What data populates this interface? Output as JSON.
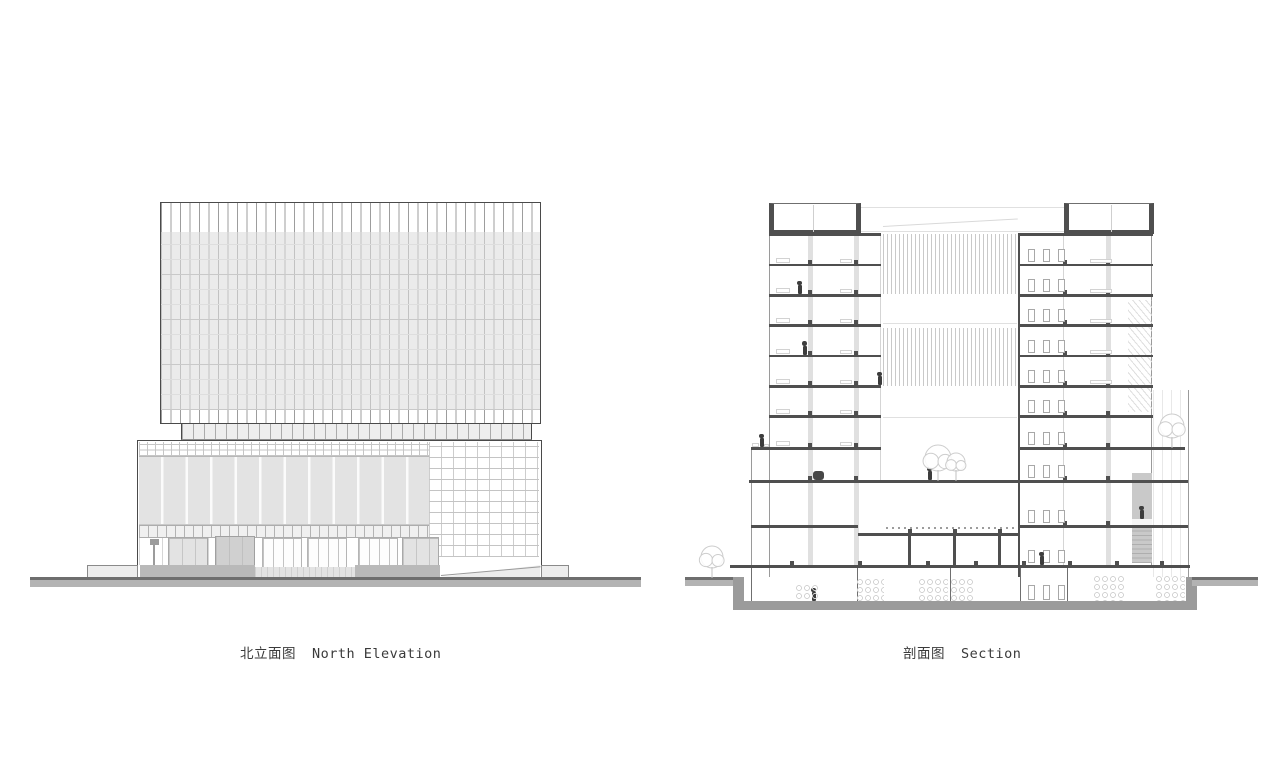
{
  "captions": {
    "elevation_zh": "北立面图",
    "elevation_en": "North Elevation",
    "section_zh": "剖面图",
    "section_en": "Section"
  },
  "colors": {
    "line_dark": "#4f4f4f",
    "ground_band": "#9b9b9b",
    "panel_gray": "#e3e3e3",
    "caption_text": "#3a3a3a",
    "background": "#ffffff"
  },
  "drawing": {
    "rects": [
      [
        "tower-box",
        160,
        202,
        381,
        222
      ],
      [
        "tw-top",
        161,
        203,
        379,
        29
      ],
      [
        "tw-mid",
        161,
        232,
        379,
        178
      ],
      [
        "tw-bot",
        161,
        410,
        379,
        13
      ],
      [
        "stepband",
        181,
        424,
        351,
        16
      ],
      [
        "pd-box",
        137,
        440,
        405,
        137
      ],
      [
        "pd-row1",
        139,
        442,
        290,
        15
      ],
      [
        "pd-panels",
        139,
        457,
        290,
        68
      ],
      [
        "pd-brick",
        429,
        442,
        110,
        115
      ],
      [
        "pd-row2",
        139,
        525,
        290,
        13
      ],
      [
        "pd-store",
        139,
        538,
        300,
        27
      ],
      [
        "door-glass",
        168,
        537,
        40,
        39
      ],
      [
        "door-dark",
        215,
        536,
        40,
        40
      ],
      [
        "bay",
        262,
        538,
        40,
        36
      ],
      [
        "bay",
        307,
        538,
        40,
        36
      ],
      [
        "bay",
        358,
        538,
        40,
        36
      ],
      [
        "door-glass",
        402,
        537,
        37,
        39
      ],
      [
        "flag",
        150,
        539,
        9,
        6
      ],
      [
        "flagpost",
        153,
        540,
        1.5,
        27
      ],
      [
        "sill-dark",
        140,
        565,
        115,
        12
      ],
      [
        "sill-light",
        255,
        567,
        100,
        10
      ],
      [
        "sill-dark",
        355,
        565,
        85,
        12
      ],
      [
        "ramp",
        440,
        564,
        100,
        13
      ],
      [
        "ramp-line",
        441,
        575,
        100,
        1,
        -5
      ],
      [
        "plinth-l",
        87,
        565,
        51,
        12
      ],
      [
        "plinth-r",
        541,
        565,
        28,
        12
      ],
      [
        "ground-el",
        30,
        577,
        611,
        10
      ],
      [
        "roofbox",
        769,
        203,
        92,
        31
      ],
      [
        "roofbox",
        1064,
        203,
        90,
        31
      ],
      [
        "roof-mull",
        813,
        205,
        1,
        27
      ],
      [
        "roof-mull",
        1111,
        205,
        1,
        27
      ],
      [
        "line-h-faint",
        861,
        207,
        203,
        1
      ],
      [
        "line-h-faint",
        861,
        231,
        203,
        1
      ],
      [
        "slope",
        883,
        226,
        135,
        1,
        -3.2
      ],
      [
        "edge-thin",
        769,
        233,
        1,
        344
      ],
      [
        "strip",
        808,
        233,
        5,
        332
      ],
      [
        "strip",
        854,
        233,
        5,
        332
      ],
      [
        "edge-faint",
        880,
        233,
        1,
        247
      ],
      [
        "edge-thin",
        751,
        447,
        1,
        130
      ],
      [
        "cutwall",
        1018,
        233,
        2,
        344
      ],
      [
        "edge-faint",
        1063,
        233,
        1,
        332
      ],
      [
        "strip",
        1106,
        233,
        5,
        332
      ],
      [
        "edge-thin",
        1151,
        233,
        1,
        332
      ],
      [
        "annex",
        1153,
        390,
        36,
        187
      ],
      [
        "edge-thin",
        1188,
        390,
        1,
        187
      ],
      [
        "stairzone",
        1128,
        300,
        24,
        112
      ],
      [
        "hatchv",
        883,
        234,
        134,
        60
      ],
      [
        "hatchv",
        883,
        328,
        134,
        58
      ],
      [
        "line-h-faint",
        883,
        323,
        134,
        1
      ],
      [
        "line-h-faint",
        883,
        417,
        134,
        1
      ],
      [
        "dash",
        886,
        527,
        130,
        2
      ],
      [
        "shaft",
        1132,
        473,
        20,
        90
      ],
      [
        "shaft-gap",
        1132,
        519,
        20,
        7
      ],
      [
        "stairlines",
        1132,
        527,
        20,
        36
      ],
      [
        "ground-el",
        685,
        577,
        55,
        9
      ],
      [
        "wallblk",
        733,
        577,
        11,
        33
      ],
      [
        "wallblk",
        1186,
        577,
        11,
        33
      ],
      [
        "baseband",
        733,
        601,
        462,
        9
      ],
      [
        "ground-el",
        1192,
        577,
        66,
        9
      ],
      [
        "bwall",
        751,
        568,
        1,
        33
      ],
      [
        "bwall",
        857,
        568,
        1,
        33
      ],
      [
        "bwall",
        950,
        568,
        1,
        33
      ],
      [
        "bwall",
        1020,
        568,
        1,
        33
      ],
      [
        "bwall",
        1067,
        568,
        1,
        33
      ],
      [
        "win",
        1028,
        585,
        7,
        15
      ],
      [
        "win",
        1043,
        585,
        7,
        15
      ],
      [
        "win",
        1058,
        585,
        7,
        15
      ],
      [
        "col",
        908,
        535,
        2.5,
        30
      ],
      [
        "col",
        953,
        535,
        2.5,
        30
      ],
      [
        "col",
        998,
        535,
        2.5,
        30
      ],
      [
        "blob",
        813,
        471,
        11,
        9
      ],
      [
        "furn",
        752,
        443,
        7,
        4
      ],
      [
        "furn",
        764,
        444,
        5,
        3
      ]
    ],
    "slab_groups": [
      {
        "x": 769,
        "w": 112,
        "h": 2.5,
        "ys": [
          233,
          263.5,
          294,
          324,
          354.5,
          385,
          415
        ]
      },
      {
        "x": 751,
        "w": 130,
        "h": 2.5,
        "ys": [
          447
        ]
      },
      {
        "x": 749,
        "w": 269,
        "h": 2.5,
        "ys": [
          480
        ]
      },
      {
        "x": 751,
        "w": 107,
        "h": 2.5,
        "ys": [
          525
        ]
      },
      {
        "x": 858,
        "w": 160,
        "h": 2.5,
        "ys": [
          533
        ]
      },
      {
        "x": 1018,
        "w": 135,
        "h": 2.5,
        "ys": [
          233,
          263.5,
          294,
          324,
          354.5,
          385,
          415
        ]
      },
      {
        "x": 1018,
        "w": 167,
        "h": 2.5,
        "ys": [
          447
        ]
      },
      {
        "x": 1018,
        "w": 170,
        "h": 2.5,
        "ys": [
          480,
          525
        ]
      },
      {
        "x": 730,
        "w": 460,
        "h": 3,
        "ys": [
          565
        ]
      }
    ],
    "stub_groups": [
      {
        "xs": [
          808,
          854
        ],
        "ys": [
          263.5,
          294,
          324,
          354.5,
          385,
          415,
          447,
          480
        ]
      },
      {
        "xs": [
          1063,
          1106
        ],
        "ys": [
          263.5,
          294,
          324,
          354.5,
          385,
          415,
          447,
          480,
          525
        ]
      },
      {
        "xs": [
          908,
          953,
          998
        ],
        "ys": [
          533
        ]
      },
      {
        "xs": [
          790,
          858,
          926,
          974,
          1022,
          1068,
          1115,
          1160
        ],
        "ys": [
          565
        ]
      }
    ],
    "windows": {
      "xs": [
        1028,
        1043,
        1058
      ],
      "floors": [
        263.5,
        294,
        324,
        354.5,
        385,
        415,
        447,
        480,
        525,
        565
      ]
    },
    "furniture": {
      "left_floors": [
        263.5,
        294,
        324,
        354.5,
        385,
        415,
        447
      ],
      "right_floors": [
        263.5,
        294,
        324,
        354.5,
        385
      ]
    },
    "persons": [
      [
        798,
        294
      ],
      [
        803,
        354.5
      ],
      [
        878,
        385
      ],
      [
        760,
        447
      ],
      [
        928,
        480
      ],
      [
        1040,
        565
      ],
      [
        1140,
        519
      ],
      [
        812,
        601
      ]
    ],
    "trees": [
      [
        712,
        577,
        11
      ],
      [
        938,
        480,
        13
      ],
      [
        956,
        480,
        9
      ],
      [
        1172,
        447,
        12
      ]
    ],
    "racks": [
      [
        856,
        578,
        28,
        23
      ],
      [
        918,
        578,
        30,
        23
      ],
      [
        950,
        578,
        24,
        23
      ],
      [
        795,
        584,
        24,
        17
      ],
      [
        1093,
        575,
        32,
        26
      ],
      [
        1155,
        575,
        30,
        26
      ]
    ]
  }
}
